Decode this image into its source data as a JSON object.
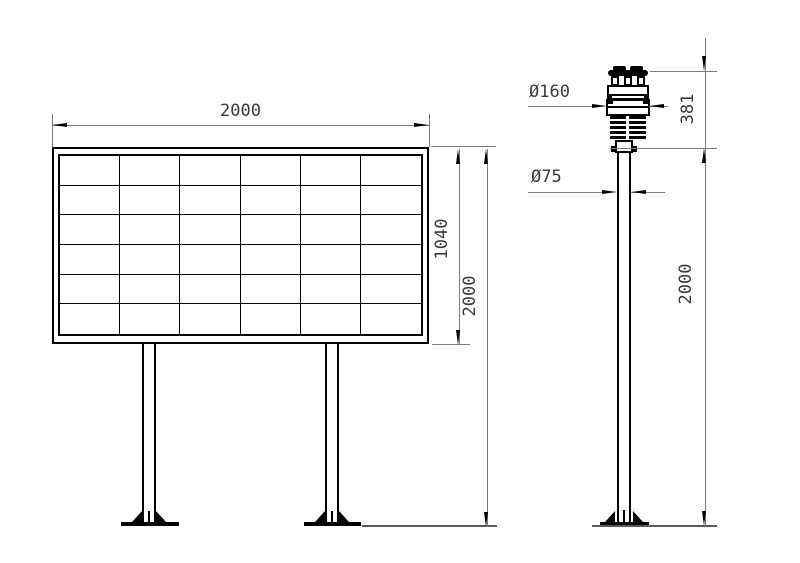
{
  "drawing": {
    "background_color": "#ffffff",
    "structure_line_color": "#000000",
    "dimension_line_color": "#7a7a7a",
    "text_color": "#3a3a3a"
  },
  "panel_view": {
    "description": "front view of gridded display board on two legs",
    "grid": {
      "rows": 6,
      "cols": 6
    },
    "dimensions": {
      "board_width": {
        "label": "2000",
        "value": 2000
      },
      "board_height": {
        "label": "1040",
        "value": 1040
      },
      "total_height": {
        "label": "2000",
        "value": 2000
      }
    }
  },
  "sensor_view": {
    "description": "side view of ultrasonic weather sensor on pole",
    "dimensions": {
      "sensor_diameter": {
        "label": "Ø160",
        "value": 160
      },
      "pole_diameter": {
        "label": "Ø75",
        "value": 75
      },
      "sensor_height": {
        "label": "381",
        "value": 381
      },
      "pole_height": {
        "label": "2000",
        "value": 2000
      }
    }
  }
}
